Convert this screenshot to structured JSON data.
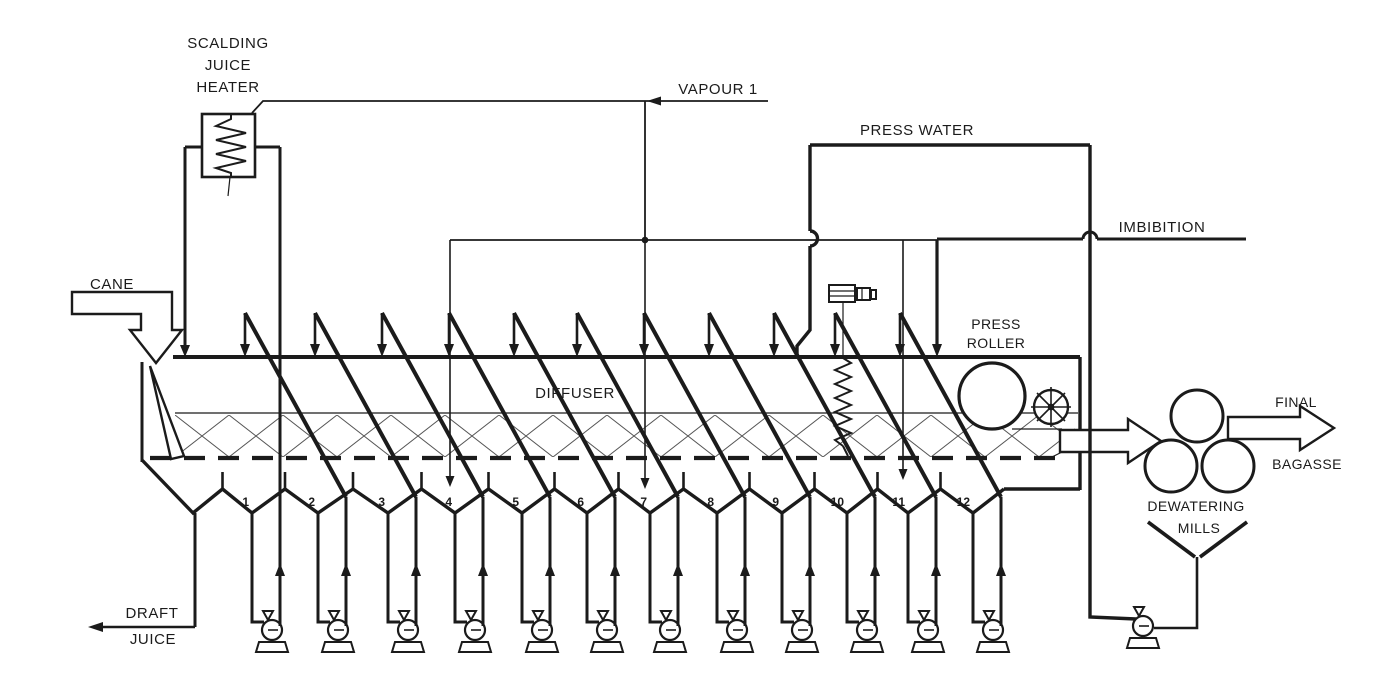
{
  "labels": {
    "scalding_juice_heater": [
      "SCALDING",
      "JUICE",
      "HEATER"
    ],
    "vapour_1": "VAPOUR 1",
    "press_water": "PRESS WATER",
    "imbibition": "IMBIBITION",
    "cane": "CANE",
    "diffuser": "DIFFUSER",
    "press_roller": [
      "PRESS",
      "ROLLER"
    ],
    "final_bagasse": [
      "FINAL",
      "BAGASSE"
    ],
    "dewatering_mills": [
      "DEWATERING",
      "MILLS"
    ],
    "draft_juice": [
      "DRAFT",
      "JUICE"
    ]
  },
  "stages": [
    "1",
    "2",
    "3",
    "4",
    "5",
    "6",
    "7",
    "8",
    "9",
    "10",
    "11",
    "12"
  ],
  "colors": {
    "line": "#1b1b1b",
    "background": "#ffffff"
  }
}
